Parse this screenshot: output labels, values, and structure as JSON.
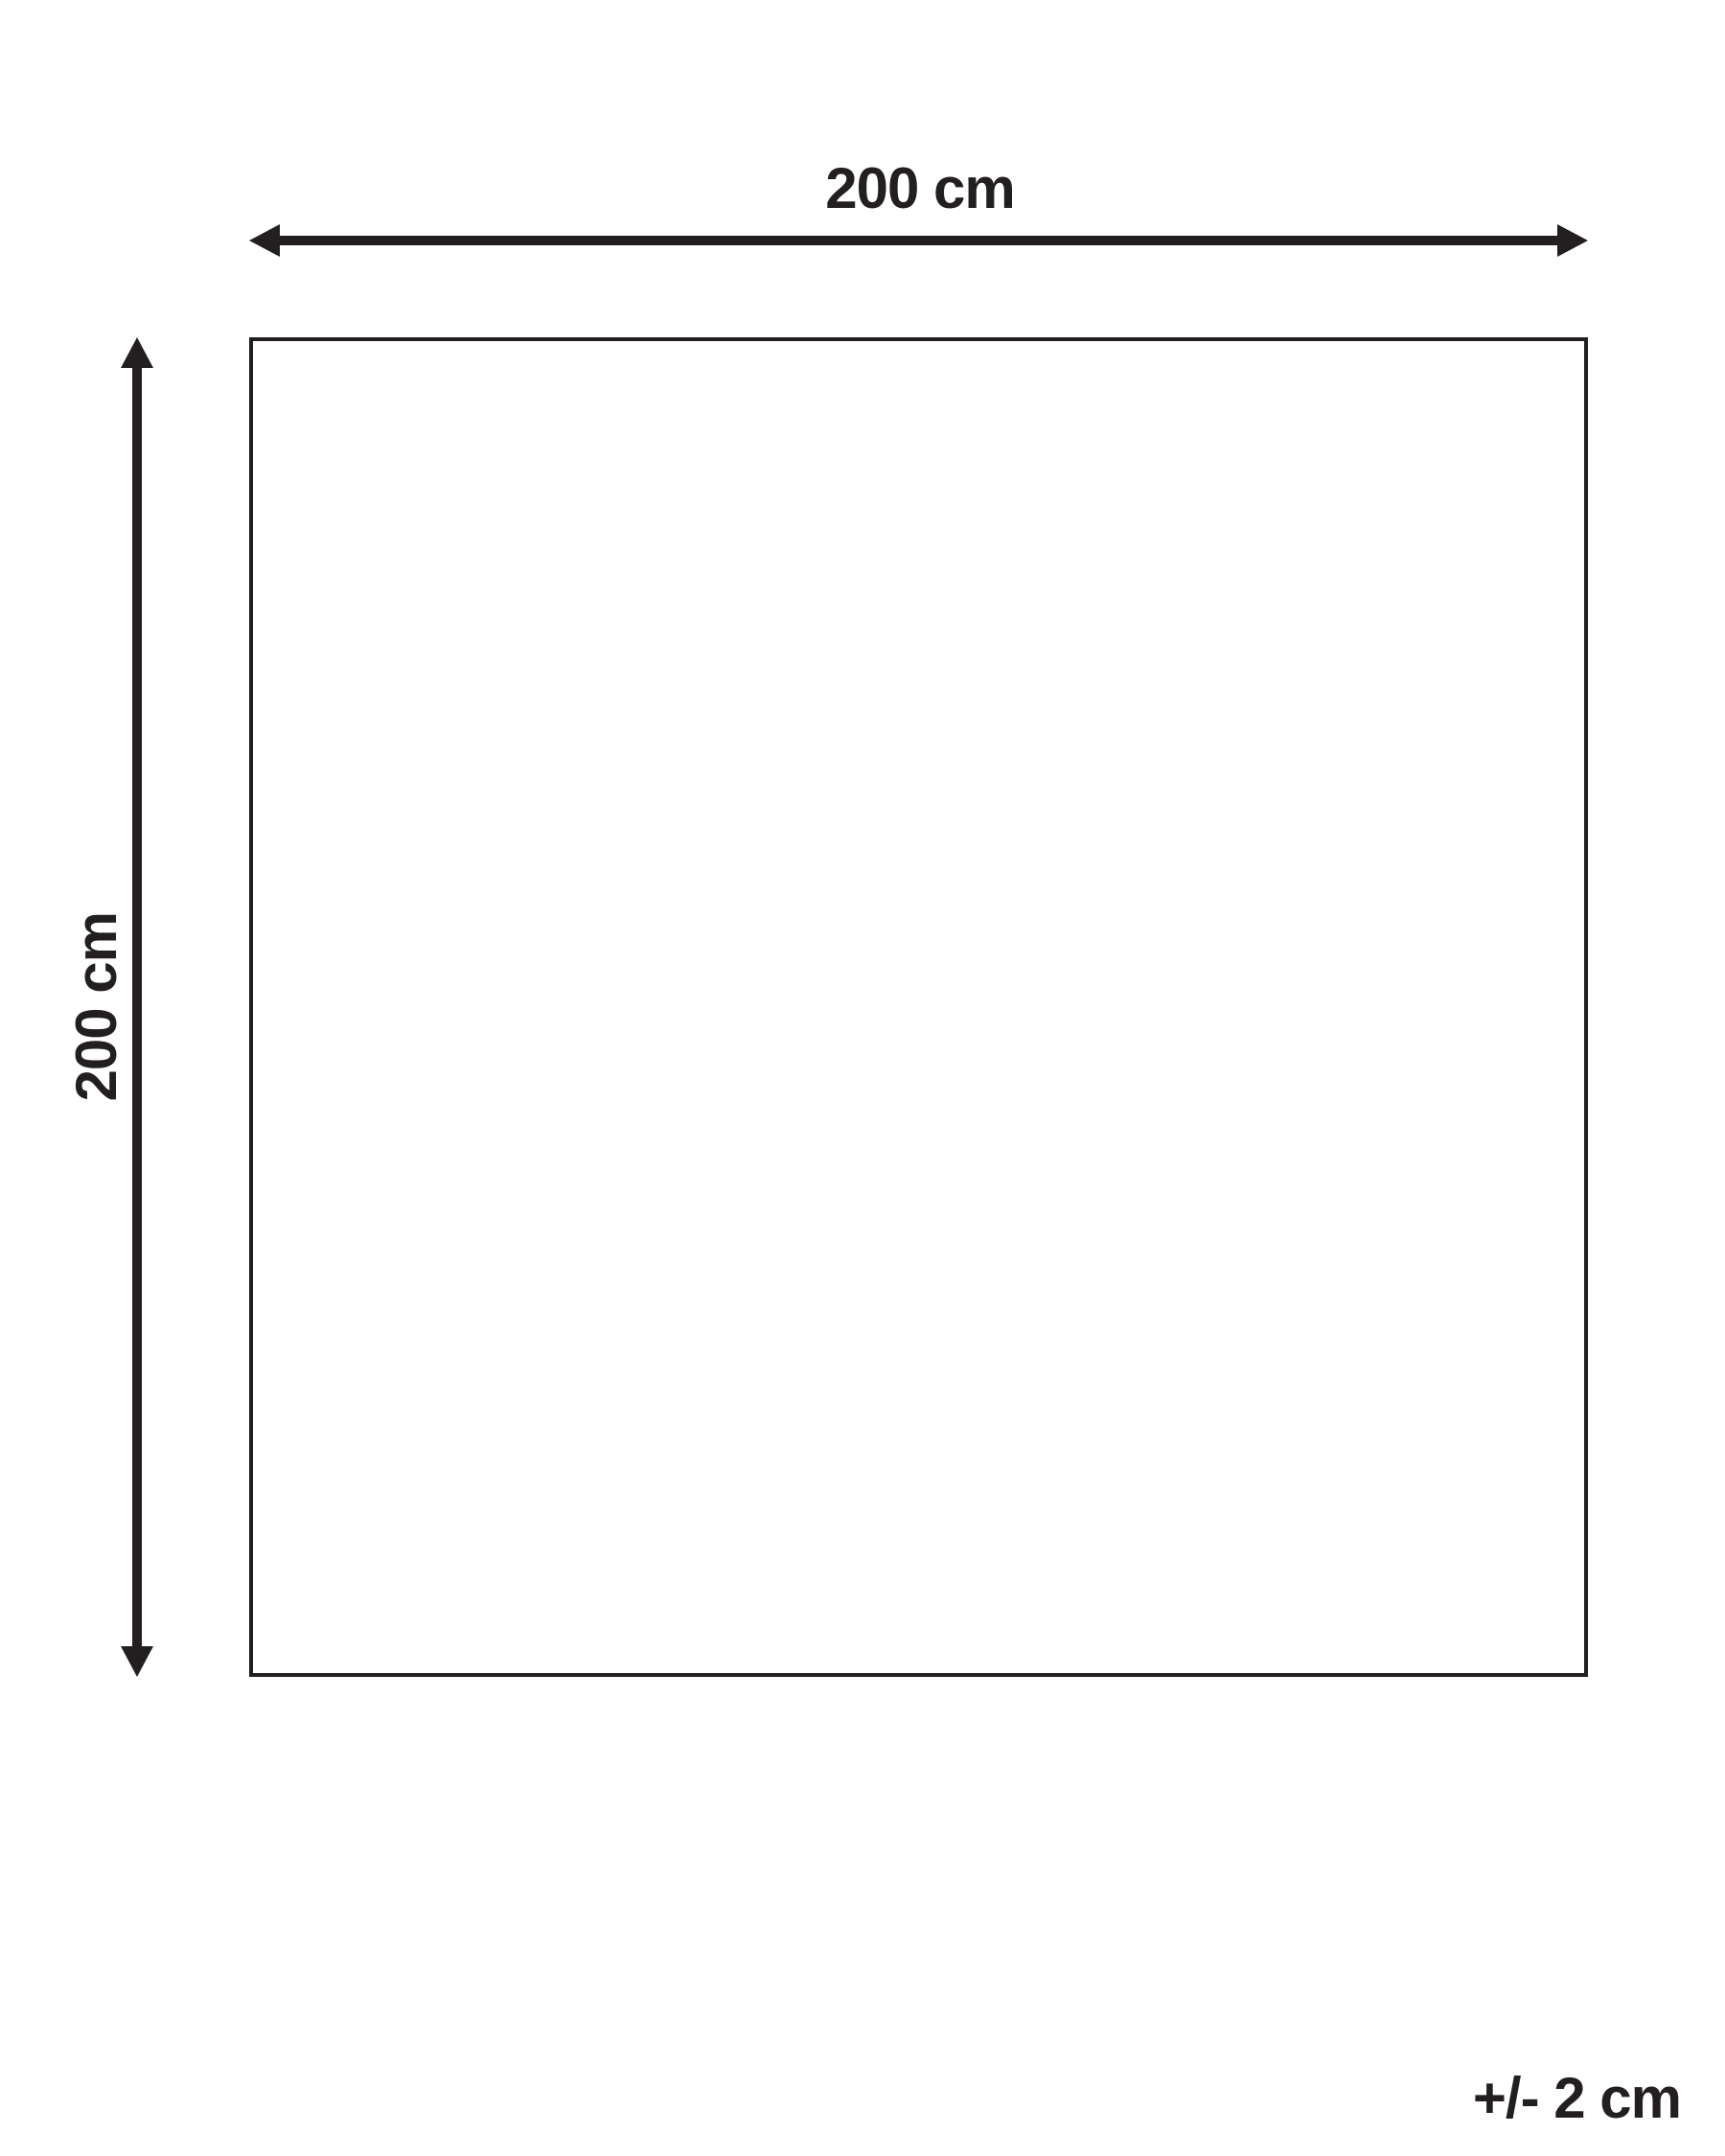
{
  "diagram": {
    "width_label": "200 cm",
    "height_label": "200 cm",
    "tolerance_label": "+/- 2 cm"
  },
  "colors": {
    "ink": "#231f20",
    "background": "#ffffff"
  }
}
